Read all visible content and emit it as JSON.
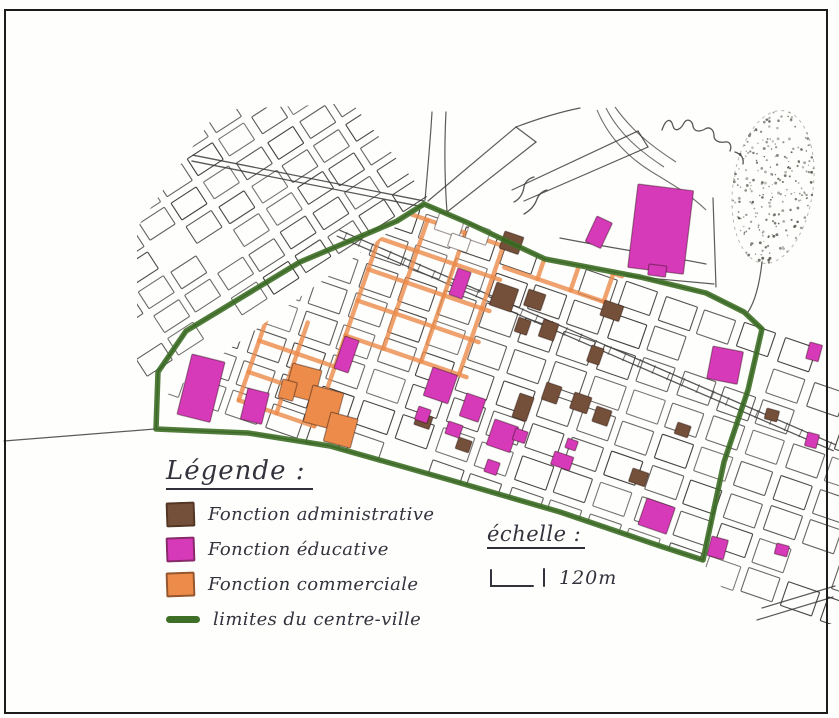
{
  "page": {
    "background": "#ffffff",
    "frame_color": "#1c1c1c"
  },
  "legend": {
    "title": "Légende :",
    "items": [
      {
        "id": "administrative",
        "label": "Fonction administrative",
        "color": "#74503a",
        "swatch": "square"
      },
      {
        "id": "educative",
        "label": "Fonction éducative",
        "color": "#d63ab8",
        "swatch": "square"
      },
      {
        "id": "commerciale",
        "label": "Fonction commerciale",
        "color": "#ec8b4a",
        "swatch": "square"
      },
      {
        "id": "limites",
        "label": "limites du centre-ville",
        "color": "#3e6f26",
        "swatch": "line"
      }
    ]
  },
  "scale": {
    "title": "échelle :",
    "label": "120m"
  },
  "map": {
    "colors": {
      "ink": "#35322e",
      "paper": "#fefefd",
      "boundary": "#3e6f26",
      "administrative": "#74503a",
      "educative": "#d63ab8",
      "commerciale": "#ec8b4a",
      "railway": "#3a3a3a",
      "stipple": "#55524a"
    },
    "boundary_points": "156,429 158,372 186,331 300,262 397,221 424,204 466,222 545,259 640,277 706,293 744,312 762,329 748,390 724,462 703,560 660,546 560,512 450,480 330,446 248,433 156,429",
    "grid_w": {
      "origin": [
        157,
        373
      ],
      "rotation": -33,
      "col_start": -10,
      "col_end": 318,
      "col_step": 38,
      "block_w": 30,
      "row_start": -302,
      "row_end": -6,
      "row_step": 28,
      "block_h": 20,
      "clip": "137,418 137,228 218,110 352,103 428,198 160,370"
    },
    "grid_e": {
      "origin": [
        424,
        206
      ],
      "rotation": 19,
      "col_start": -204,
      "col_end": 540,
      "col_step": 42,
      "block_w": 33,
      "row_start": 6,
      "row_end": 258,
      "row_step": 33,
      "block_h": 25,
      "clips": [
        "160,400 424,206 550,262 706,293 758,326 740,420 700,560 560,512 330,446 157,430",
        "766,322 839,350 839,624 750,624 702,562 758,330"
      ]
    },
    "railway": {
      "x1": 338,
      "y1": 233,
      "x2": 835,
      "y2": 448,
      "gap": 3.2,
      "tick": 16
    },
    "boulevard": {
      "x1": 192,
      "y1": 158,
      "x2": 424,
      "y2": 204,
      "gap": 3
    },
    "roads": [
      "M 428,201 L 516,127",
      "M 447,212 L 536,142",
      "M 516,127 L 536,142",
      "M 512,190 L 638,131",
      "M 524,201 L 648,147",
      "M 638,131 L 648,147",
      "M 516,127 C 540,118 560,112 580,108",
      "M 560,238 C 622,250 666,256 706,264",
      "M 626,276 L 714,284",
      "M 713,198 L 716,287",
      "M 4,441 L 155,429",
      "M 757,620 L 833,597",
      "M 762,608 L 835,586",
      "M 432,112 C 430,146 427,176 425,200",
      "M 446,112 C 444,150 445,185 447,212",
      "M 748,312 C 756,300 760,280 762,262"
    ],
    "railway_curves": [
      "M 597,110 C 608,136 626,156 652,172",
      "M 606,108 C 618,132 638,150 664,167",
      "M 615,107 C 630,128 648,144 676,162",
      "M 652,172 C 672,184 692,196 706,210"
    ],
    "commercial_streets": [
      [
        -32,
        12,
        -32,
        148
      ],
      [
        8,
        12,
        8,
        148
      ],
      [
        48,
        12,
        48,
        148
      ],
      [
        88,
        12,
        88,
        148
      ],
      [
        -32,
        12,
        96,
        12
      ],
      [
        -32,
        45,
        96,
        45
      ],
      [
        -32,
        78,
        96,
        78
      ],
      [
        -32,
        111,
        96,
        111
      ],
      [
        -32,
        148,
        96,
        148
      ],
      [
        -112,
        148,
        -112,
        244
      ],
      [
        -72,
        148,
        -72,
        244
      ],
      [
        -32,
        148,
        -32,
        244
      ],
      [
        -112,
        181,
        -32,
        181
      ],
      [
        -112,
        214,
        -32,
        214
      ],
      [
        -112,
        244,
        -32,
        244
      ],
      [
        96,
        2,
        210,
        2
      ],
      [
        96,
        32,
        210,
        32
      ],
      [
        131,
        2,
        131,
        32
      ],
      [
        166,
        2,
        166,
        32
      ],
      [
        201,
        2,
        201,
        32
      ]
    ],
    "blocks": {
      "educative": [
        [
          638,
          184,
          56,
          84,
          7
        ],
        [
          597,
          216,
          17,
          28,
          25
        ],
        [
          649,
          264,
          18,
          11,
          7
        ],
        [
          192,
          354,
          34,
          62,
          14
        ],
        [
          248,
          388,
          22,
          32,
          14
        ],
        [
          345,
          336,
          15,
          34,
          19
        ],
        [
          458,
          268,
          14,
          28,
          19
        ],
        [
          433,
          367,
          26,
          30,
          19
        ],
        [
          419,
          406,
          13,
          14,
          19
        ],
        [
          449,
          421,
          15,
          13,
          19
        ],
        [
          467,
          393,
          20,
          24,
          19
        ],
        [
          488,
          459,
          13,
          13,
          19
        ],
        [
          495,
          419,
          25,
          27,
          19
        ],
        [
          516,
          428,
          13,
          12,
          19
        ],
        [
          555,
          451,
          20,
          14,
          19
        ],
        [
          568,
          438,
          11,
          10,
          19
        ],
        [
          647,
          498,
          30,
          28,
          19
        ],
        [
          713,
          346,
          31,
          33,
          11
        ],
        [
          810,
          342,
          13,
          17,
          15
        ],
        [
          712,
          536,
          17,
          20,
          15
        ],
        [
          777,
          543,
          13,
          11,
          15
        ],
        [
          808,
          432,
          12,
          14,
          15
        ]
      ],
      "administrative": [
        [
          497,
          282,
          23,
          24,
          19
        ],
        [
          529,
          289,
          18,
          17,
          19
        ],
        [
          519,
          317,
          13,
          15,
          19
        ],
        [
          544,
          319,
          16,
          18,
          19
        ],
        [
          605,
          300,
          20,
          16,
          19
        ],
        [
          592,
          345,
          13,
          17,
          19
        ],
        [
          547,
          382,
          16,
          18,
          19
        ],
        [
          575,
          392,
          18,
          17,
          19
        ],
        [
          520,
          393,
          15,
          25,
          19
        ],
        [
          597,
          406,
          16,
          16,
          19
        ],
        [
          633,
          468,
          17,
          14,
          19
        ],
        [
          505,
          231,
          20,
          18,
          19
        ],
        [
          418,
          412,
          16,
          13,
          19
        ],
        [
          459,
          437,
          14,
          12,
          19
        ],
        [
          767,
          408,
          13,
          11,
          15
        ],
        [
          678,
          422,
          14,
          12,
          19
        ]
      ],
      "commerciale": [
        [
          293,
          363,
          30,
          32,
          15
        ],
        [
          313,
          385,
          32,
          38,
          15
        ],
        [
          331,
          412,
          28,
          30,
          15
        ],
        [
          283,
          379,
          15,
          19,
          15
        ]
      ],
      "plain": [
        [
          440,
          212,
          26,
          18,
          19
        ],
        [
          470,
          223,
          22,
          16,
          19
        ],
        [
          452,
          233,
          20,
          14,
          19
        ]
      ]
    },
    "stipple": {
      "cx": 773,
      "cy": 187,
      "rx": 40,
      "ry": 77,
      "rotation": 8,
      "count": 240
    },
    "annotations": [
      {
        "name": "handwritten-annotation-top-right",
        "d": "M 662,130 c 4,-12 9,-12 11,-4 c 2,7 8,3 11,-3 c 3,-5 8,-3 9,3 c 1,6 7,6 12,3 c 5,-3 9,1 9,7 c 0,5 6,7 11,6 c 5,-1 7,4 5,9 M 735,152 c 6,2 9,6 8,12"
      },
      {
        "name": "handwritten-annotation-center",
        "d": "M 514,202 c 6,-3 9,-9 10,-15 c 1,-6 6,-9 10,-10 M 524,214 c 7,-4 11,-9 13,-15 c 2,-5 6,-8 10,-9"
      }
    ]
  }
}
